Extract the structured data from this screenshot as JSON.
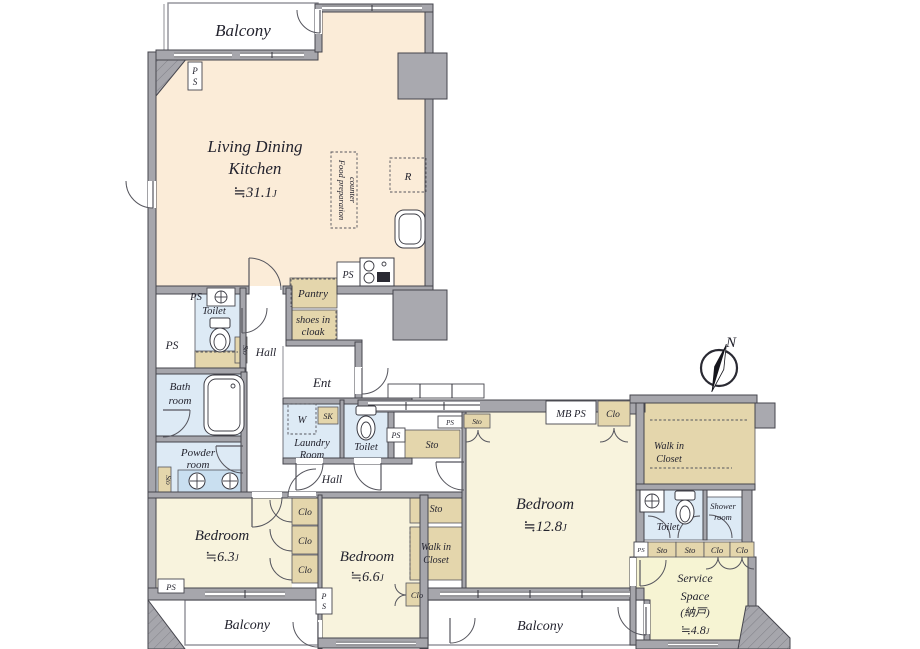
{
  "plan_type": "apartment-floor-plan",
  "labels": {
    "ps": "PS",
    "p": "P",
    "s": "S",
    "sto": "Sto",
    "clo": "Clo",
    "mb_ps": "MB PS",
    "w": "W",
    "sk": "SK",
    "r": "R",
    "north": "N",
    "unit": "J"
  },
  "rooms": {
    "balcony": "Balcony",
    "ldk": {
      "line1": "Living Dining",
      "line2": "Kitchen",
      "size": "≒31.1"
    },
    "food_prep": {
      "line1": "Food preparation",
      "line2": "counter"
    },
    "pantry": "Pantry",
    "shoes": {
      "line1": "shoes in",
      "line2": "cloak"
    },
    "toilet": "Toilet",
    "bath": {
      "line1": "Bath",
      "line2": "room"
    },
    "hall": "Hall",
    "ent": "Ent",
    "laundry": {
      "line1": "Laundry",
      "line2": "Room"
    },
    "powder": {
      "line1": "Powder",
      "line2": "room"
    },
    "bedroom": "Bedroom",
    "bedroom_main_size": "≒12.8",
    "bedroom_b_size": "≒6.3",
    "bedroom_c_size": "≒6.6",
    "wic": {
      "line1": "Walk in",
      "line2": "Closet"
    },
    "shower": {
      "line1": "Shower",
      "line2": "room"
    },
    "service": {
      "line1": "Service",
      "line2": "Space",
      "line3": "(納戸)",
      "size": "≒4.8"
    }
  },
  "colors": {
    "ldk_floor": "#fbecd8",
    "bedroom_floor": "#f8f3dd",
    "service_floor": "#f6f4d3",
    "closet_tan": "#e4d6ac",
    "wet_blue": "#ddeaf5",
    "counter_blue": "#c9dff0",
    "wall_gray": "#a6a6ac",
    "line_dark": "#45454d",
    "text": "#23232e"
  }
}
